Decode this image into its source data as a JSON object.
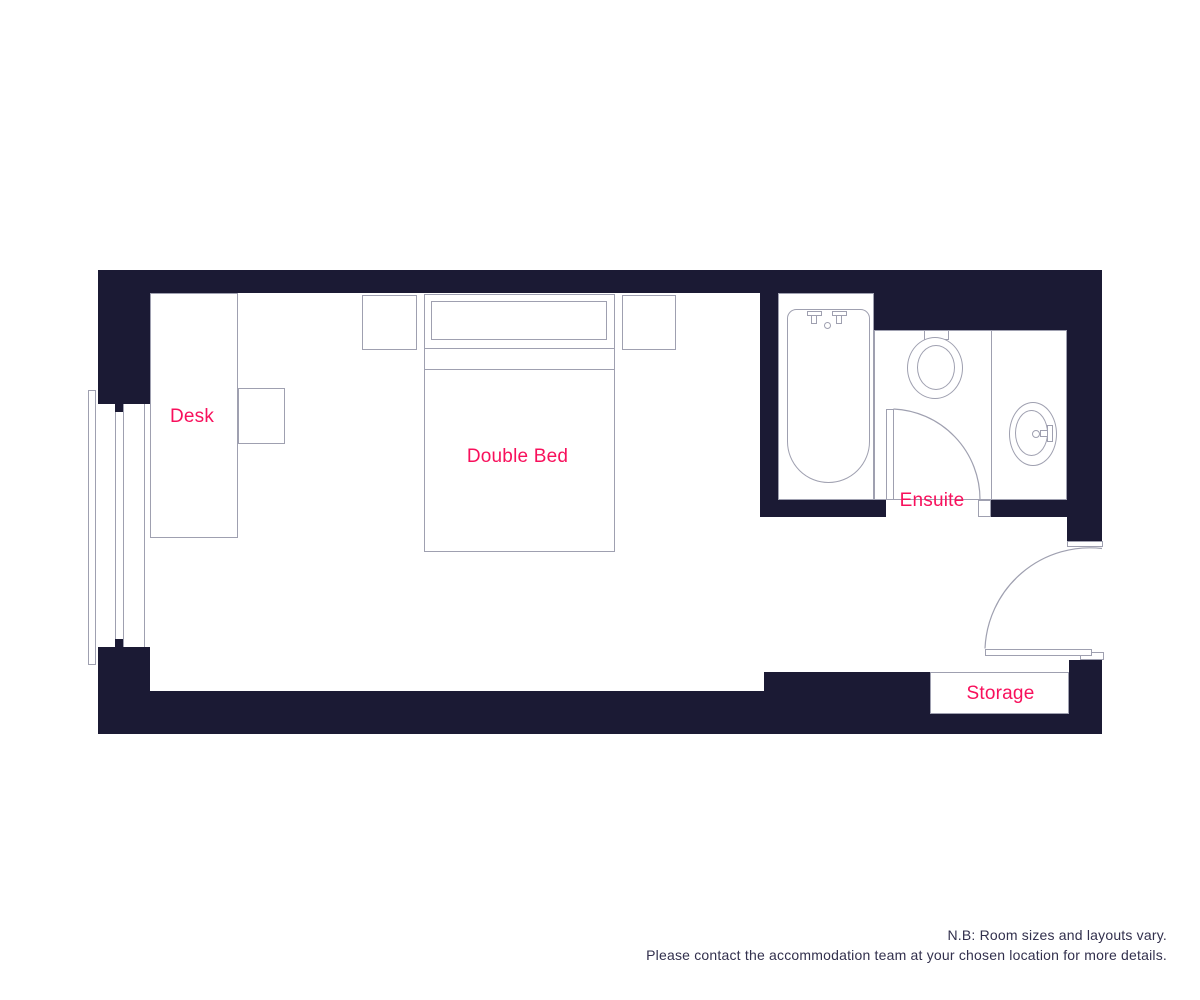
{
  "plan": {
    "labels": {
      "desk": "Desk",
      "double_bed": "Double Bed",
      "ensuite": "Ensuite",
      "storage": "Storage"
    }
  },
  "note": {
    "line1": "N.B: Room sizes and layouts vary.",
    "line2": "Please contact the accommodation team at your chosen location for more details."
  },
  "colors": {
    "wall": "#1B1A34",
    "label_pink": "#F8105C",
    "outline_gray": "#9FA0B0",
    "note_text": "#32304D",
    "background": "#FFFFFF"
  }
}
